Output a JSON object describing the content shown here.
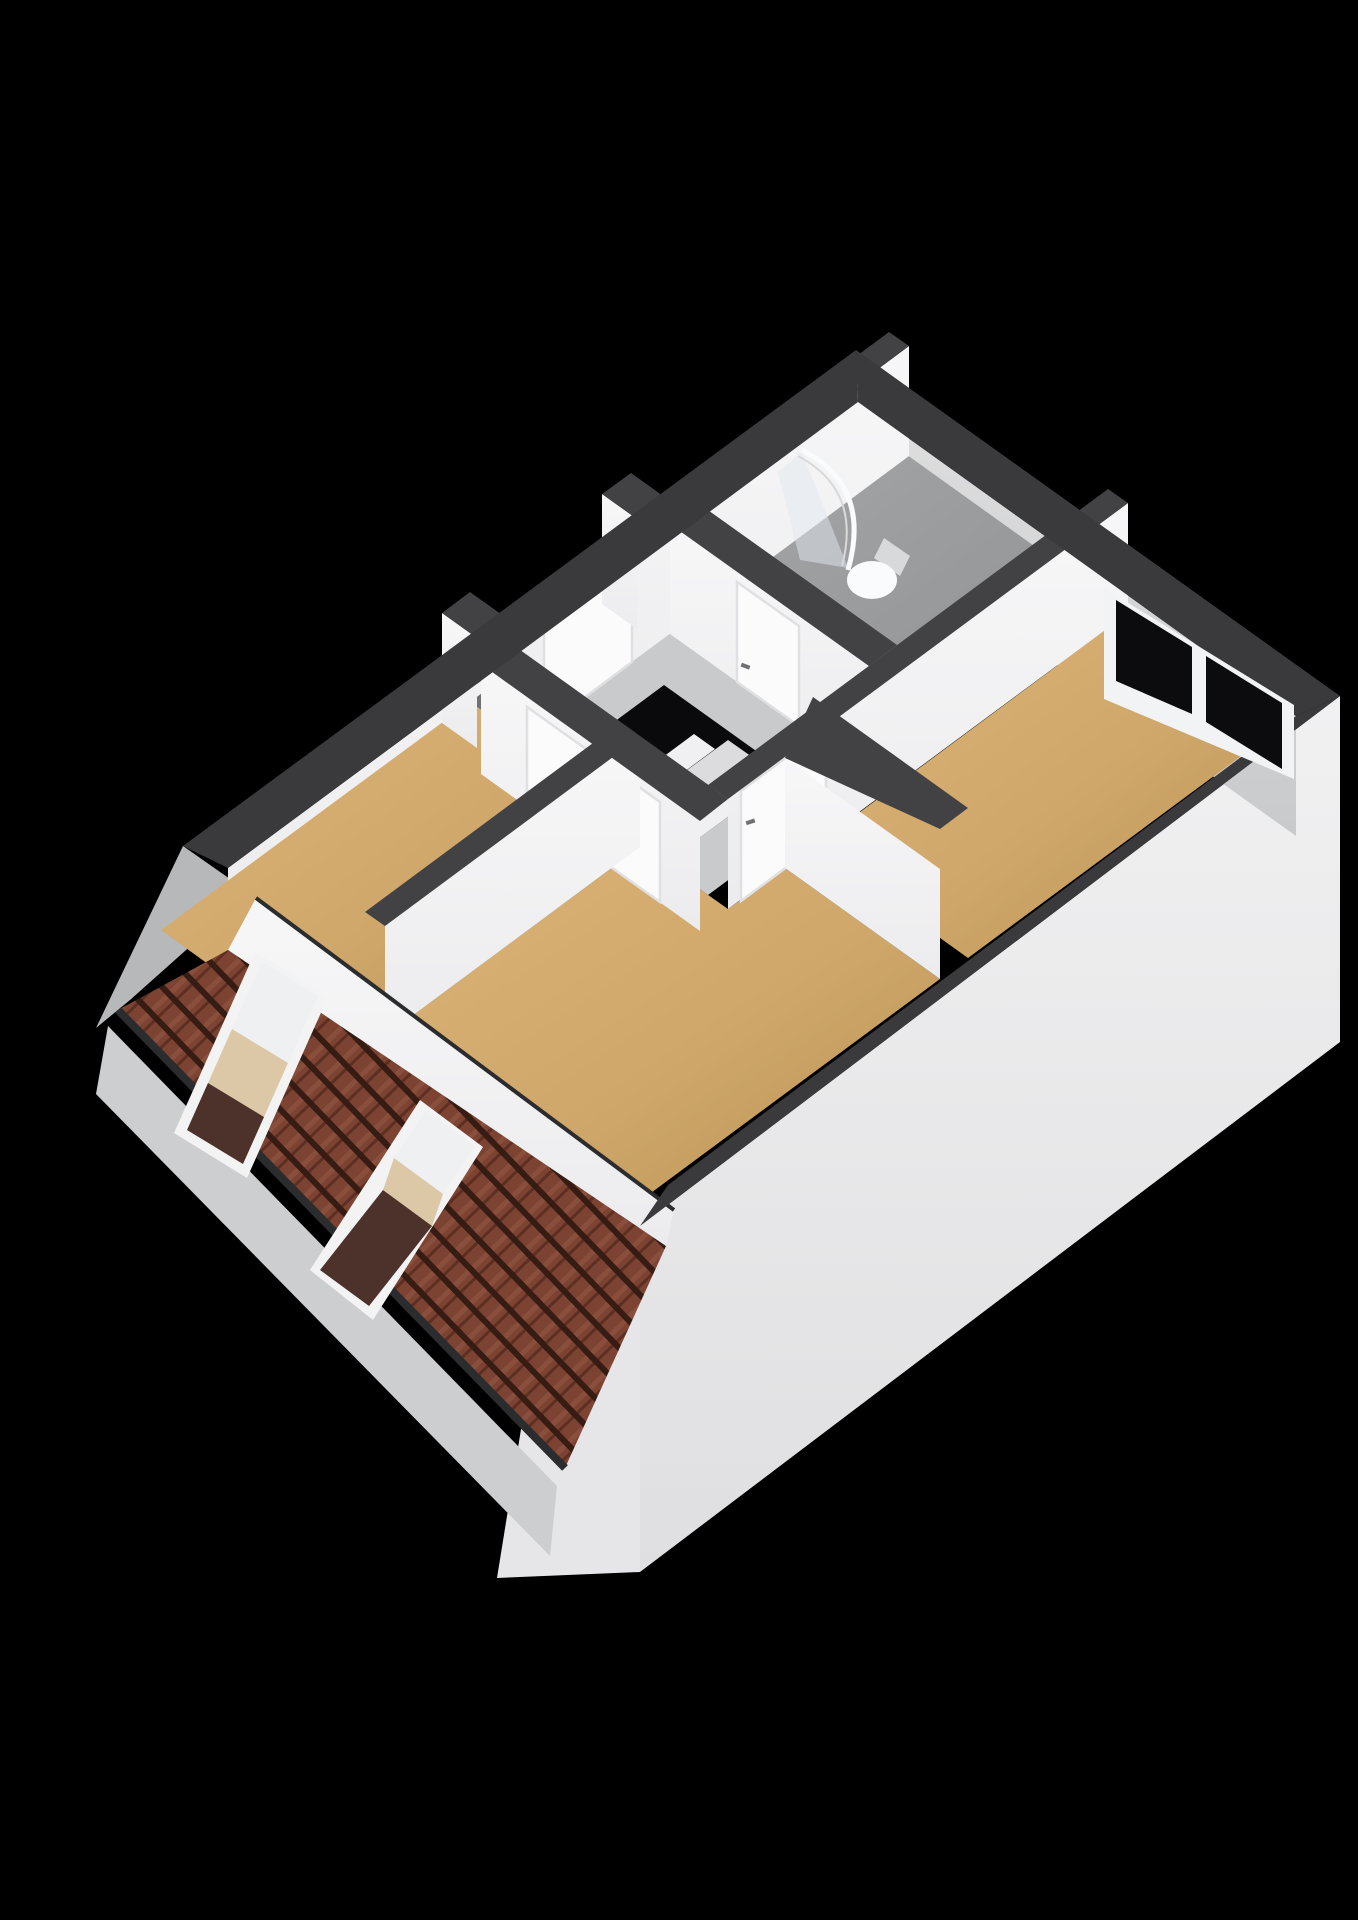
{
  "scene": {
    "type": "3d-floorplan-render",
    "background": "#000000",
    "view": "isometric-cutaway-attic-floor"
  },
  "palette": {
    "band": "#3a3a3c",
    "band_inner": "#424244",
    "fascia": "#2b2c2e",
    "wall_face_white": "#f7f7f8",
    "wall_face_white2": "#ececee",
    "wall_face_gray": "#dededf",
    "wall_face_gray2": "#c9cacc",
    "ext_wedge": "#f1f1f2",
    "ext_wedge_dark": "#dfdfe1",
    "ext_end": "#e6e6e8",
    "eave_band": "#cdced0",
    "gable": "#b7b8ba",
    "floor_tan": "#cfa76b",
    "floor_tan_dark": "#b6904e",
    "floor_tan_light": "#ddb478",
    "floor_bath": "#a6a7a9",
    "floor_bath_dark": "#8e8f91",
    "floor_hall": "#c9cacc",
    "floor_closet": "#707173",
    "tile_base": "#7c4332",
    "tile_dark": "#371c14",
    "tile_mid": "#5d2f22",
    "tile_light": "#8a4f3c",
    "skylight_frame": "#f3f3f4",
    "skylight_glass": "#eef0f1",
    "skylight_reveal": "#dcc8a6",
    "skylight_dark": "#4c322a",
    "window_frame": "#f2f3f4",
    "window_pane": "#0c0c0f",
    "door": "#fbfbfc",
    "door_frame": "#e0e0e2",
    "handle": "#6f7072",
    "stair_hole": "#0a0a0c",
    "step": "#f0f0f2",
    "step_shade": "#dcdcdf",
    "fixture": "#fafbfc",
    "fixture_shade": "#d7d9db",
    "glass": "rgba(226,232,237,0.5)"
  },
  "rooms": [
    {
      "name": "bedroom-left",
      "floor": "tan"
    },
    {
      "name": "bedroom-middle",
      "floor": "tan"
    },
    {
      "name": "bedroom-right",
      "floor": "tan"
    },
    {
      "name": "bathroom",
      "floor": "gray"
    },
    {
      "name": "hallway-landing",
      "floor": "gray"
    },
    {
      "name": "closet",
      "floor": "darkgray"
    }
  ],
  "fixtures": [
    {
      "name": "shower-enclosure",
      "room": "bathroom"
    },
    {
      "name": "toilet",
      "room": "bathroom"
    },
    {
      "name": "staircase",
      "room": "hallway-landing",
      "steps": 3
    }
  ],
  "openings": {
    "wall_window": {
      "count": 1,
      "panes": 2
    },
    "roof_windows": {
      "count": 2
    },
    "doors": {
      "count": 5
    }
  }
}
